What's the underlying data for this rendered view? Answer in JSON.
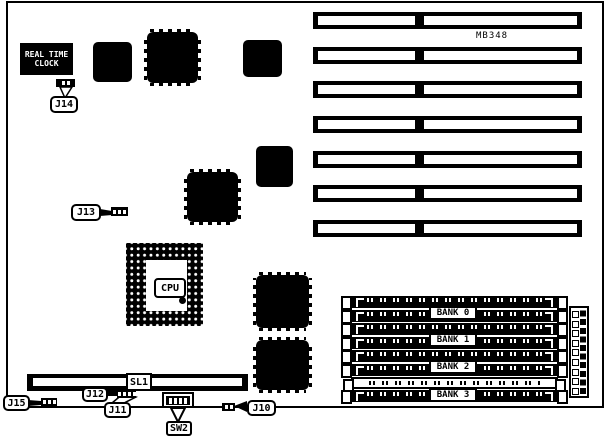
{
  "board": {
    "model_label": "MB348",
    "rtc": {
      "line1": "REAL TIME",
      "line2": "CLOCK"
    },
    "cpu": {
      "label": "CPU"
    },
    "sl1_label": "SL1",
    "memory": {
      "bank_labels": [
        "BANK 0",
        "BANK 1",
        "BANK 2",
        "BANK 3"
      ]
    },
    "callouts": {
      "j10": "J10",
      "j11": "J11",
      "j12": "J12",
      "j13": "J13",
      "j14": "J14",
      "j15": "J15",
      "sw2": "SW2"
    },
    "counts": {
      "isa_slots": 7,
      "simm_sockets": 8
    },
    "colors": {
      "ink": "#000000",
      "paper": "#ffffff"
    }
  }
}
